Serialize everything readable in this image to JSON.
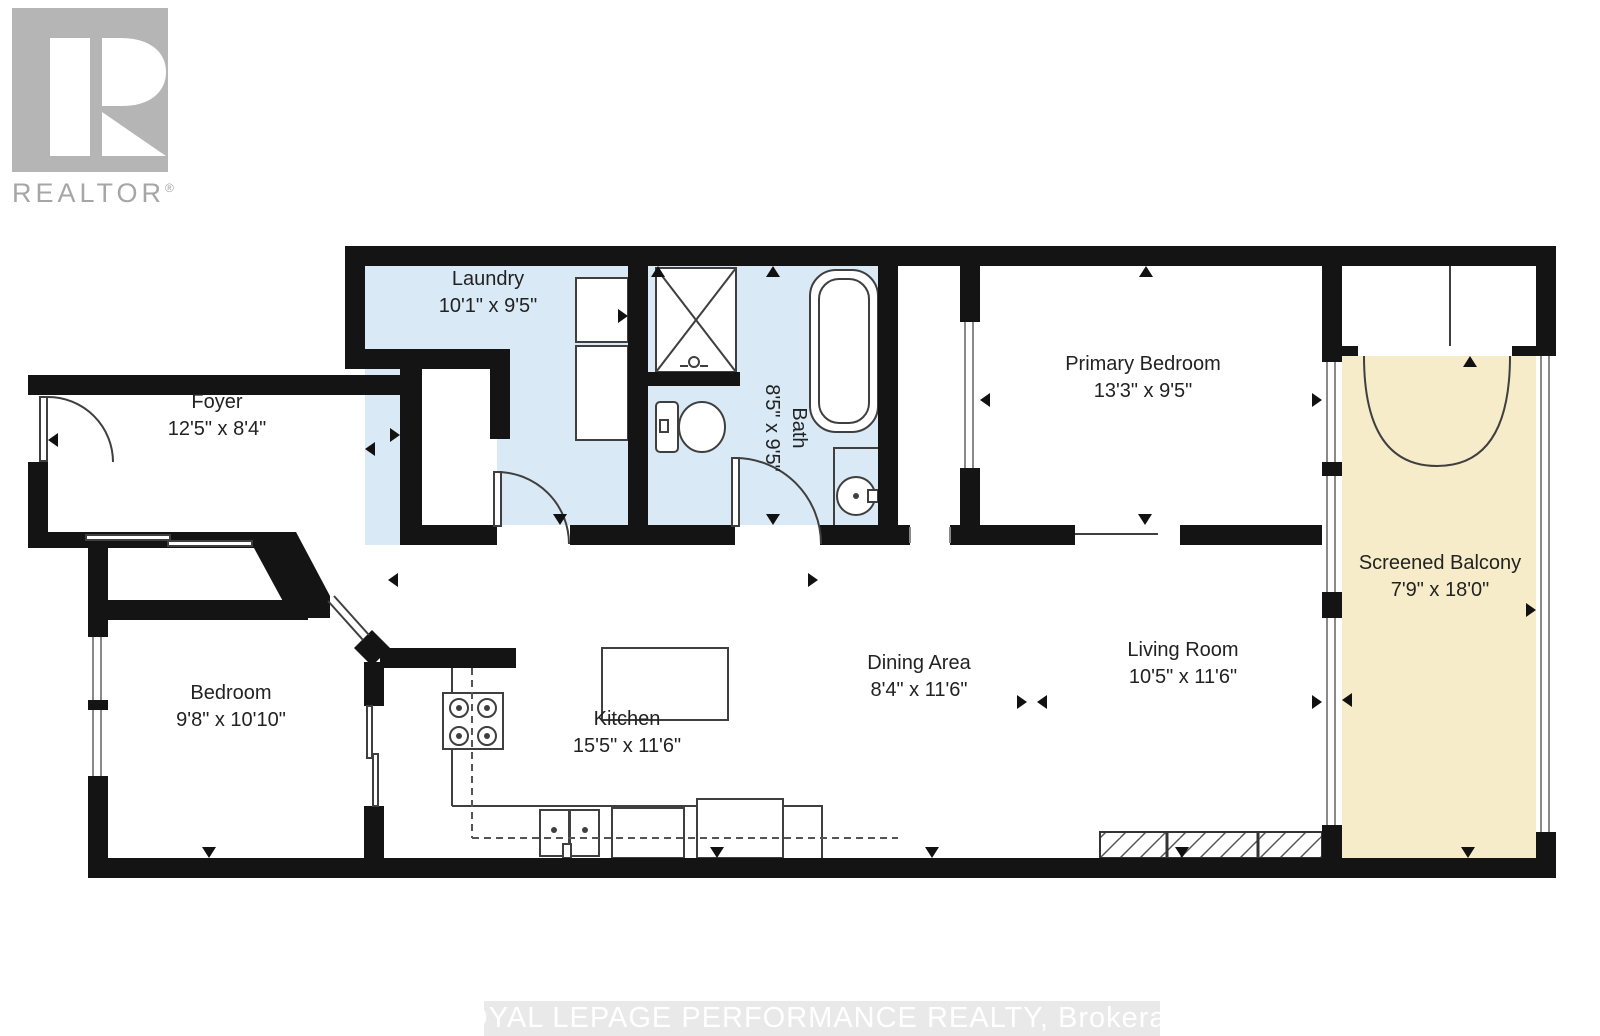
{
  "page": {
    "type": "floor-plan"
  },
  "logo": {
    "text": "REALTOR",
    "registered_mark": "®"
  },
  "watermark": {
    "text": "ROYAL LEPAGE PERFORMANCE REALTY, Brokerage"
  },
  "colors": {
    "wall": "#141414",
    "wet_room_floor": "#d9e9f6",
    "balcony_floor": "#f6ecca",
    "fixture_line": "#3f3f3f",
    "window_line": "#8a8a8a",
    "label_text": "#222222",
    "logo_gray": "#b5b5b5",
    "logo_text_gray": "#a6a6a6",
    "watermark_bg": "#e9e9e9",
    "watermark_text": "#ffffff"
  },
  "rooms": [
    {
      "id": "laundry",
      "label": "Laundry",
      "dims": "10'1\" x 9'5\"",
      "x": 488,
      "y": 293,
      "rotated": false
    },
    {
      "id": "foyer",
      "label": "Foyer",
      "dims": "12'5\" x 8'4\"",
      "x": 217,
      "y": 416,
      "rotated": false
    },
    {
      "id": "bath",
      "label": "Bath",
      "dims": "8'5\" x 9'5\"",
      "x": 785,
      "y": 428,
      "rotated": true
    },
    {
      "id": "primary-bedroom",
      "label": "Primary Bedroom",
      "dims": "13'3\" x 9'5\"",
      "x": 1143,
      "y": 378,
      "rotated": false
    },
    {
      "id": "screened-balcony",
      "label": "Screened Balcony",
      "dims": "7'9\" x 18'0\"",
      "x": 1440,
      "y": 577,
      "rotated": false
    },
    {
      "id": "bedroom",
      "label": "Bedroom",
      "dims": "9'8\" x 10'10\"",
      "x": 231,
      "y": 707,
      "rotated": false
    },
    {
      "id": "kitchen",
      "label": "Kitchen",
      "dims": "15'5\" x 11'6\"",
      "x": 627,
      "y": 733,
      "rotated": false
    },
    {
      "id": "dining-area",
      "label": "Dining Area",
      "dims": "8'4\" x 11'6\"",
      "x": 919,
      "y": 677,
      "rotated": false
    },
    {
      "id": "living-room",
      "label": "Living Room",
      "dims": "10'5\" x 11'6\"",
      "x": 1183,
      "y": 664,
      "rotated": false
    }
  ]
}
